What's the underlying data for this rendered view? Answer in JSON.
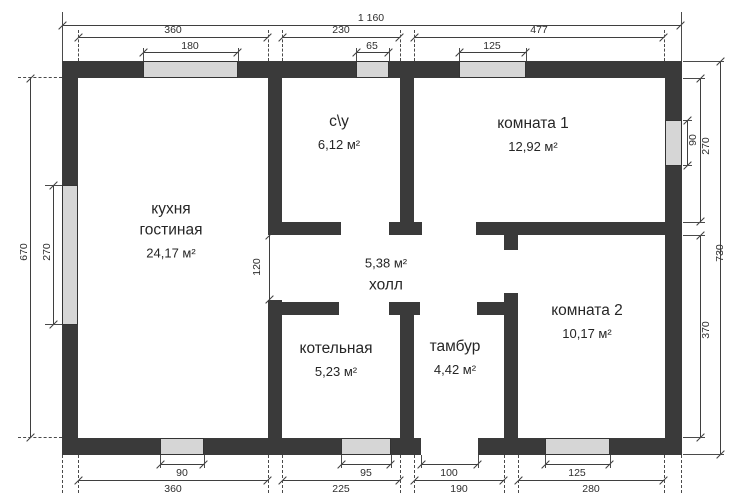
{
  "rooms": {
    "kitchen": {
      "name": "кухня",
      "name2": "гостиная",
      "area": "24,17 м²"
    },
    "bathroom": {
      "name": "с\\у",
      "area": "6,12 м²"
    },
    "room1": {
      "name": "комната 1",
      "area": "12,92 м²"
    },
    "hall": {
      "name": "холл",
      "area": "5,38 м²"
    },
    "boiler": {
      "name": "котельная",
      "area": "5,23 м²"
    },
    "vestibule": {
      "name": "тамбур",
      "area": "4,42 м²"
    },
    "room2": {
      "name": "комната 2",
      "area": "10,17 м²"
    }
  },
  "dims": {
    "top_total": "1 160",
    "top_seg1": "360",
    "top_seg2": "230",
    "top_seg3": "477",
    "top_win1": "180",
    "top_win2": "65",
    "top_win3": "125",
    "bottom_win1": "90",
    "bottom_win2": "95",
    "bottom_door": "100",
    "bottom_win3": "125",
    "bottom_seg1": "360",
    "bottom_seg2": "225",
    "bottom_seg3": "190",
    "bottom_seg4": "280",
    "left_total": "670",
    "left_win": "270",
    "right_win": "90",
    "right_upper": "270",
    "right_lower": "370",
    "right_total": "730",
    "hall_opening": "120"
  },
  "colors": {
    "wall": "#3a3a3a",
    "window_fill": "#d6d6d6",
    "line": "#3f3f3f",
    "text": "#262626",
    "background": "#ffffff"
  }
}
